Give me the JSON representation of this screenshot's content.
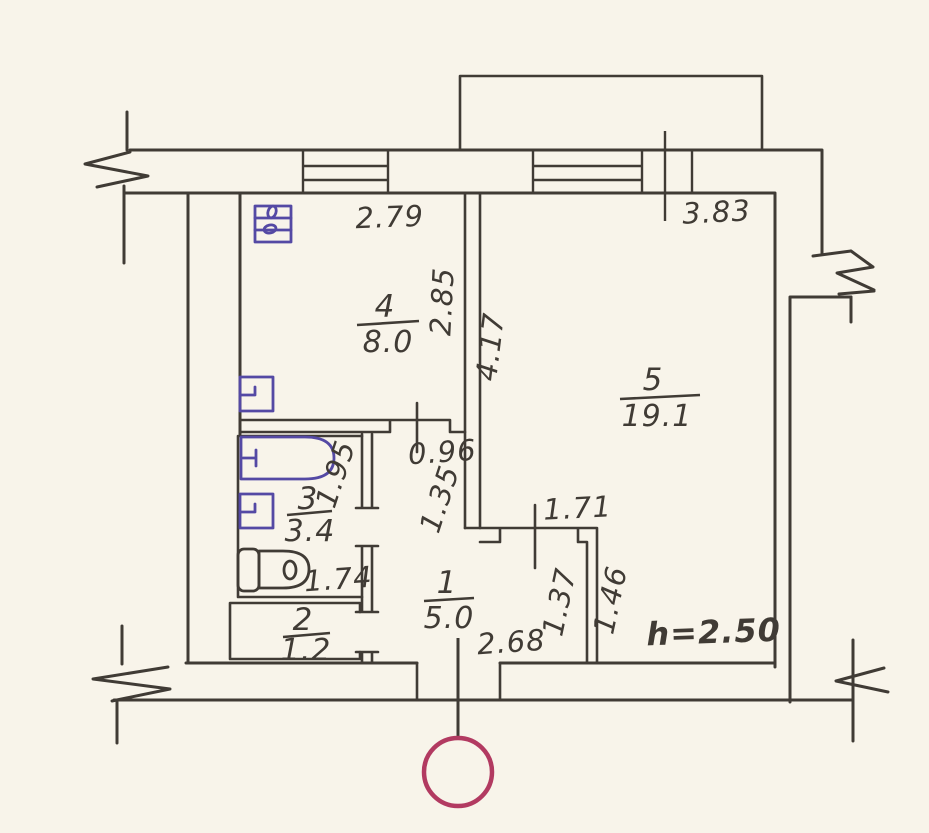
{
  "plan": {
    "title": "apartment-floor-plan",
    "rooms": {
      "hall": {
        "number": "1",
        "area": "5.0"
      },
      "closet": {
        "number": "2",
        "area": "1.2"
      },
      "bathroom": {
        "number": "3",
        "area": "3.4"
      },
      "kitchen": {
        "number": "4",
        "area": "8.0"
      },
      "living": {
        "number": "5",
        "area": "19.1"
      }
    },
    "dimensions": {
      "kitchen_width": "2.79",
      "kitchen_depth": "2.85",
      "living_width": "3.83",
      "living_depth": "4.17",
      "hall_opening": "0.96",
      "hall_side": "1.35",
      "bath_length": "1.95",
      "toilet_span": "1.74",
      "niche_width": "1.71",
      "niche_left": "1.37",
      "niche_right": "1.46",
      "hall_width": "2.68"
    },
    "notes": {
      "ceiling_height": "h=2.50"
    },
    "icons": [
      "stove-icon",
      "kitchen-sink-icon",
      "bathtub-icon",
      "washbasin-icon",
      "toilet-icon",
      "entrance-marker"
    ],
    "colors": {
      "ink": "#403b35",
      "fixtures": "#5449a4",
      "height_note": "#4a3fa8",
      "entrance": "#b23a61",
      "paper": "#f8f4ea"
    }
  }
}
